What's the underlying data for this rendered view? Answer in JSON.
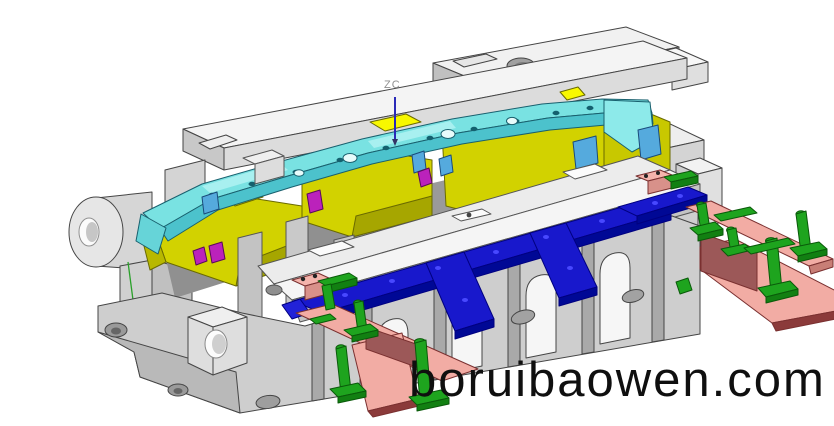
{
  "scene": {
    "type": "3d-cad-render",
    "description": "Isometric CAD rendering of an automotive stamping die / injection mold assembly",
    "background": "#ffffff"
  },
  "annotation": {
    "axis_label": "ZC"
  },
  "watermark": {
    "text": "boruibaowen.com"
  },
  "colors": {
    "outline": "#454545",
    "base_light": "#f4f4f4",
    "base_mid": "#cecece",
    "base_dark": "#a9a9a9",
    "part_cyan": "#79e2e2",
    "part_cyan_shade": "#4cc2cc",
    "insert_yellow": "#d2d200",
    "insert_yellow_shade": "#a6a600",
    "insert_yellow_bright": "#f8f800",
    "runner_blue": "#1818cc",
    "runner_blue_shade": "#000895",
    "slide_pink": "#f2aca4",
    "slide_pink_shade": "#d8918a",
    "slide_mauve": "#9c5858",
    "slide_base_red": "#8b3a3a",
    "pin_green": "#1ea41e",
    "pin_green_shade": "#128012",
    "detail_magenta": "#bb22bb",
    "detail_lightblue": "#55aadd",
    "axis_blue": "#2a2ab8",
    "label_gray": "#8f8f8f",
    "watermark_black": "#0f0f0f"
  },
  "parts": [
    {
      "name": "mold-base",
      "color": "#cecece"
    },
    {
      "name": "molded-panel",
      "color": "#79e2e2"
    },
    {
      "name": "cavity-inserts",
      "color": "#d2d200"
    },
    {
      "name": "runner-plates",
      "color": "#1818cc"
    },
    {
      "name": "slide-plates",
      "color": "#f2aca4"
    },
    {
      "name": "guide-posts",
      "color": "#1ea41e"
    },
    {
      "name": "small-inserts",
      "color": "#bb22bb"
    }
  ]
}
